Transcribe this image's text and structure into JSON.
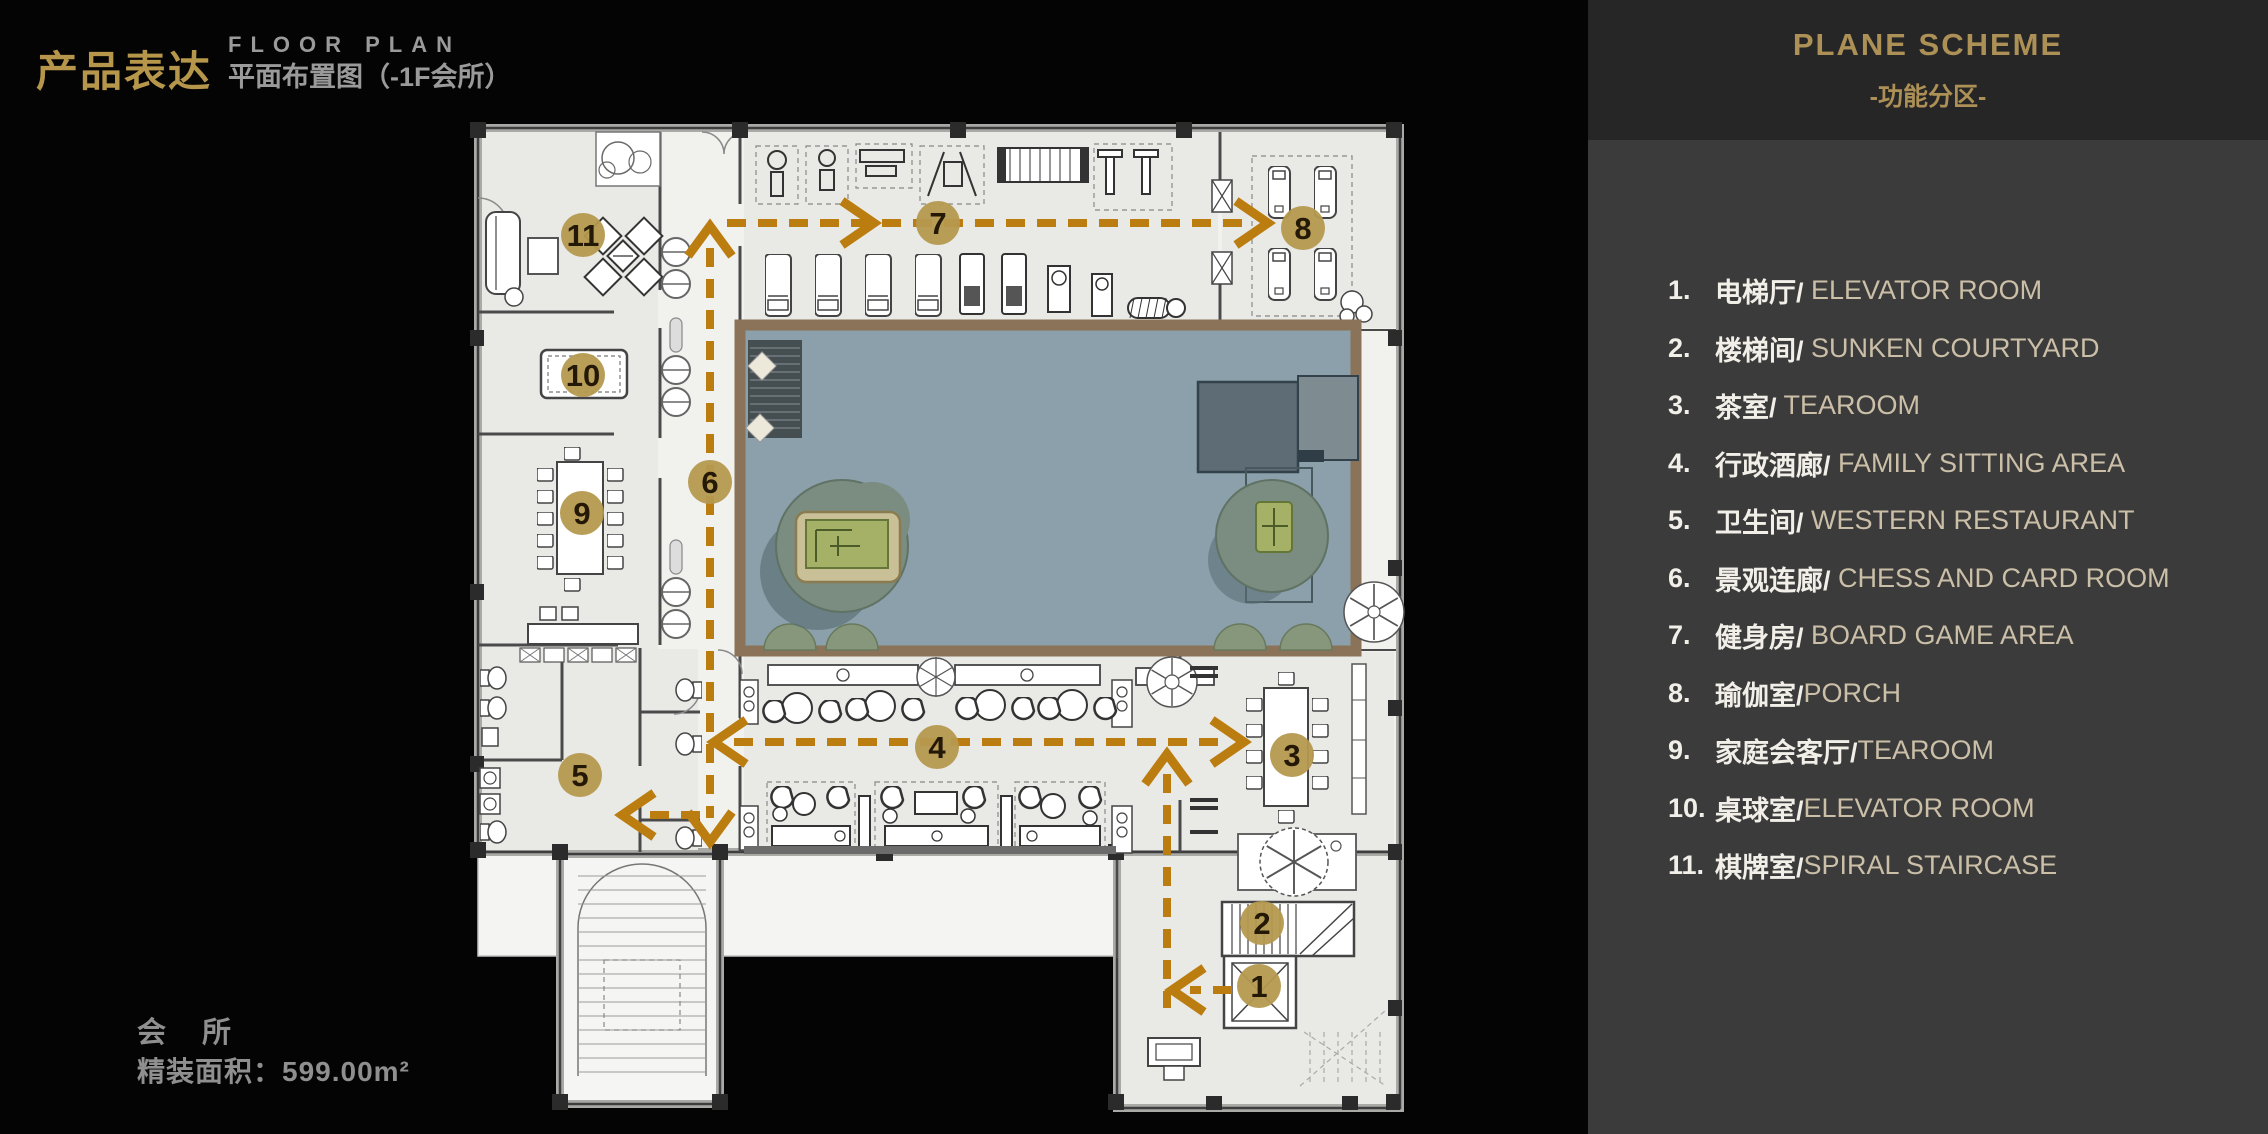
{
  "slide": {
    "kicker_cn": "产品表达",
    "kicker_en": "FLOOR PLAN",
    "subtitle_cn": "平面布置图（-1F会所）",
    "footer_name": "会 所",
    "footer_area": "精装面积：599.00m²"
  },
  "panel": {
    "title": "PLANE SCHEME",
    "subtitle": "-功能分区-",
    "items": [
      {
        "num": "1.",
        "cn": "电梯厅/",
        "en": " ELEVATOR ROOM"
      },
      {
        "num": "2.",
        "cn": "楼梯间/",
        "en": " SUNKEN COURTYARD"
      },
      {
        "num": "3.",
        "cn": "茶室/",
        "en": " TEAROOM"
      },
      {
        "num": "4.",
        "cn": "行政酒廊/",
        "en": " FAMILY SITTING AREA"
      },
      {
        "num": "5.",
        "cn": "卫生间/",
        "en": " WESTERN RESTAURANT"
      },
      {
        "num": "6.",
        "cn": "景观连廊/",
        "en": " CHESS AND CARD ROOM"
      },
      {
        "num": "7.",
        "cn": "健身房/",
        "en": " BOARD GAME AREA"
      },
      {
        "num": "8.",
        "cn": "瑜伽室/",
        "en": "PORCH"
      },
      {
        "num": "9.",
        "cn": "家庭会客厅/",
        "en": "TEAROOM"
      },
      {
        "num": "10.",
        "cn": "桌球室/",
        "en": "ELEVATOR ROOM"
      },
      {
        "num": "11.",
        "cn": "棋牌室/",
        "en": "SPIRAL STAIRCASE"
      }
    ]
  },
  "plan": {
    "markers": [
      {
        "label": "1",
        "x": 1259,
        "y": 986
      },
      {
        "label": "2",
        "x": 1262,
        "y": 923
      },
      {
        "label": "3",
        "x": 1292,
        "y": 755
      },
      {
        "label": "4",
        "x": 937,
        "y": 747
      },
      {
        "label": "5",
        "x": 580,
        "y": 775
      },
      {
        "label": "6",
        "x": 710,
        "y": 482
      },
      {
        "label": "7",
        "x": 938,
        "y": 223
      },
      {
        "label": "8",
        "x": 1303,
        "y": 228
      },
      {
        "label": "9",
        "x": 582,
        "y": 513
      },
      {
        "label": "10",
        "x": 583,
        "y": 375
      },
      {
        "label": "11",
        "x": 583,
        "y": 235
      }
    ],
    "colors": {
      "marker": "#b5994f",
      "marker_text": "#241806",
      "route": "#bb7c10",
      "courtyard": "#8ba0aa",
      "courtyard_border": "#8a7358",
      "accent_gold": "#b5964a",
      "panel_gold": "#ac9056",
      "text_gray": "#9a9a9a",
      "legend_beige": "#cbbfa8"
    }
  }
}
